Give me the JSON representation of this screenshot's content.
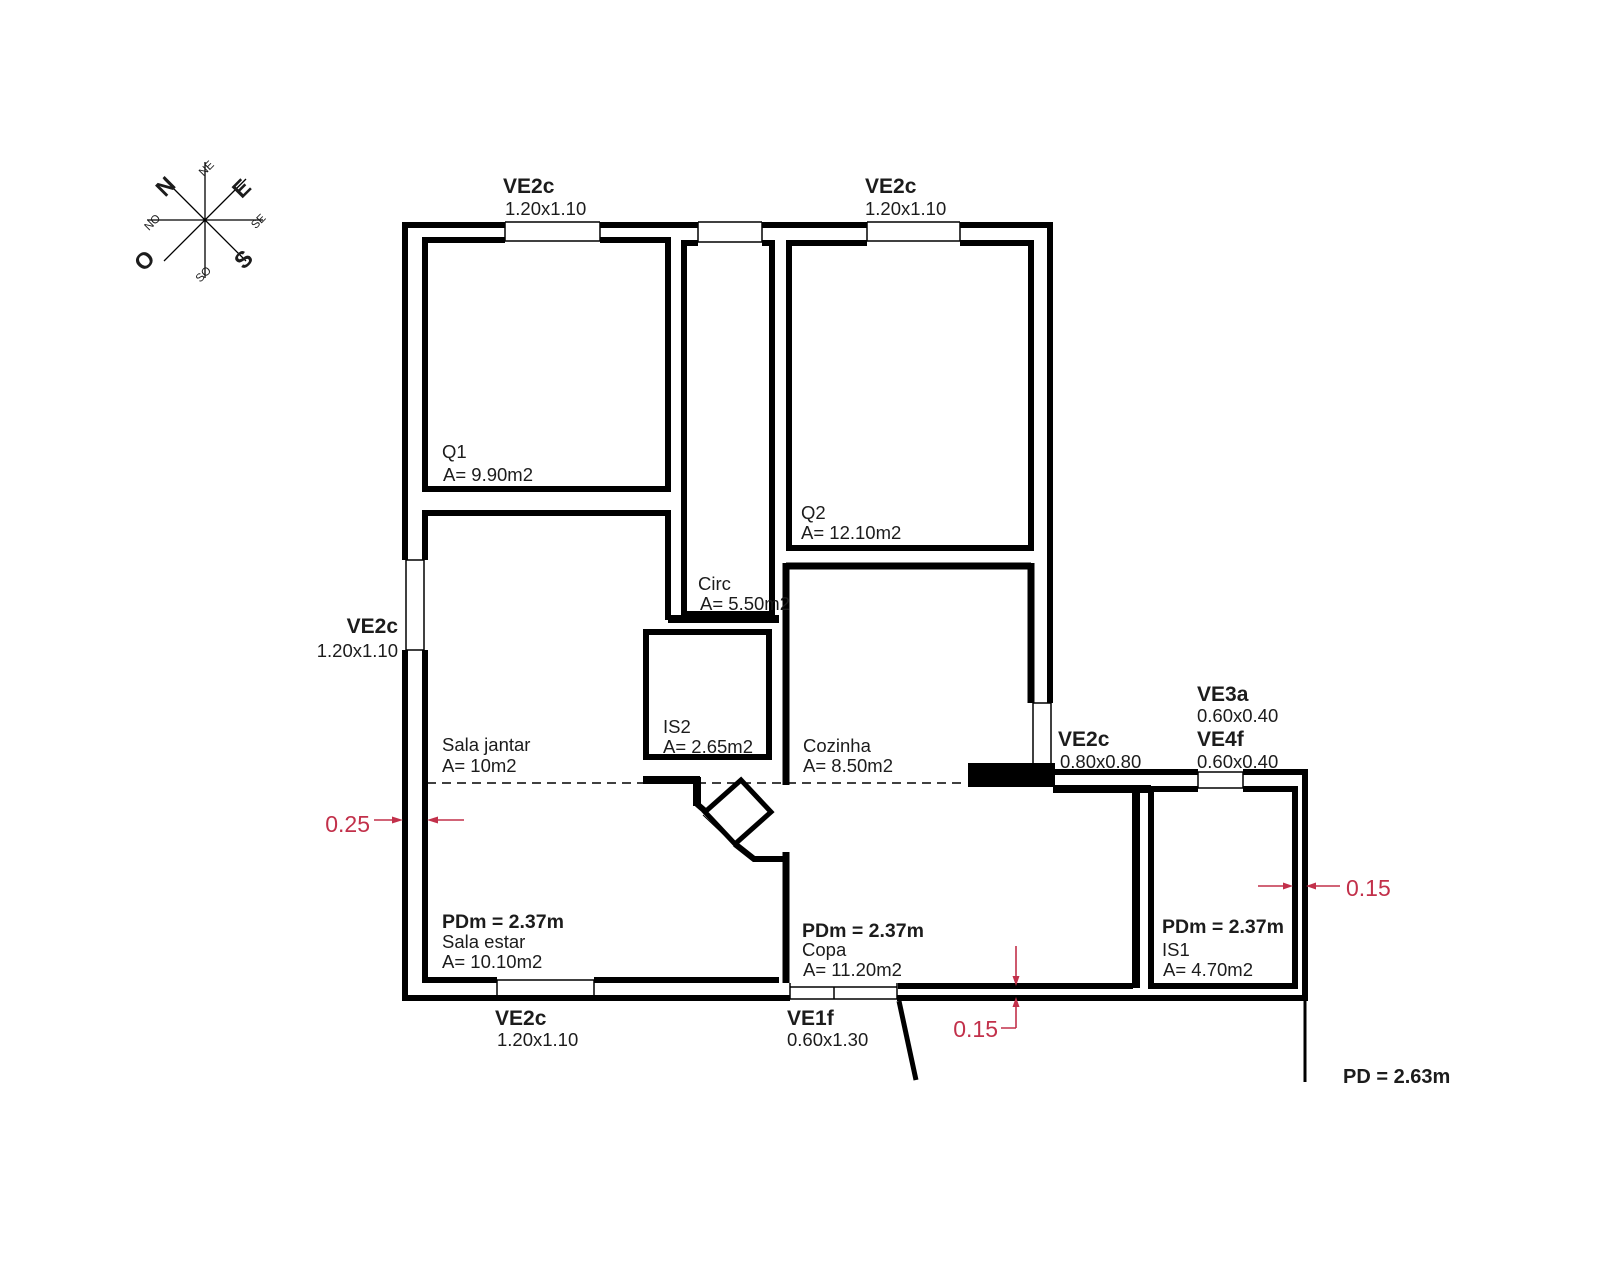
{
  "drawing": {
    "type": "floor-plan",
    "ceiling_note": "PD = 2.63m",
    "section_ceiling": "PDm = 2.37m"
  },
  "compass": {
    "n": "N",
    "e": "E",
    "s": "S",
    "o": "O",
    "ne": "NE",
    "se": "SE",
    "so": "SO",
    "no": "NO"
  },
  "windows": {
    "top_left": {
      "code": "VE2c",
      "size": "1.20x1.10"
    },
    "top_right": {
      "code": "VE2c",
      "size": "1.20x1.10"
    },
    "left": {
      "code": "VE2c",
      "size": "1.20x1.10"
    },
    "kitchen": {
      "code": "VE2c",
      "size": "0.80x0.80"
    },
    "ve3a": {
      "code": "VE3a",
      "size": "0.60x0.40"
    },
    "ve4f": {
      "code": "VE4f",
      "size": "0.60x0.40"
    },
    "bottom": {
      "code": "VE2c",
      "size": "1.20x1.10"
    },
    "entrance": {
      "code": "VE1f",
      "size": "0.60x1.30"
    }
  },
  "rooms": {
    "q1": {
      "name": "Q1",
      "area": "A= 9.90m2"
    },
    "q2": {
      "name": "Q2",
      "area": "A= 12.10m2"
    },
    "circ": {
      "name": "Circ",
      "area": "A= 5.50m2"
    },
    "is2": {
      "name": "IS2",
      "area": "A= 2.65m2"
    },
    "cozinha": {
      "name": "Cozinha",
      "area": "A= 8.50m2"
    },
    "sala_jantar": {
      "name": "Sala jantar",
      "area": "A= 10m2"
    },
    "sala_estar": {
      "pdm": "PDm = 2.37m",
      "name": "Sala estar",
      "area": "A= 10.10m2"
    },
    "copa": {
      "pdm": "PDm = 2.37m",
      "name": "Copa",
      "area": "A= 11.20m2"
    },
    "is1": {
      "pdm": "PDm = 2.37m",
      "name": "IS1",
      "area": "A= 4.70m2"
    }
  },
  "dimensions": {
    "wall_left": "0.25",
    "wall_bottom": "0.15",
    "wall_right": "0.15"
  },
  "ceiling": {
    "pd": "PD = 2.63m"
  },
  "colors": {
    "wall": "#000000",
    "dimension": "#c2304a",
    "background": "#ffffff"
  }
}
